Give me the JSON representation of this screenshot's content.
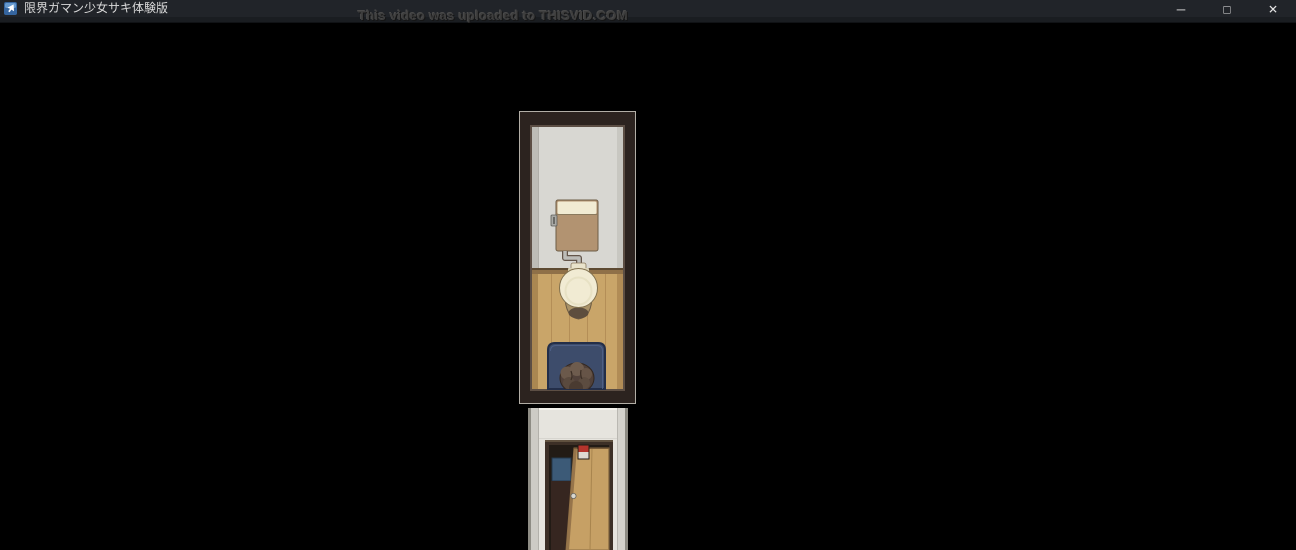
{
  "window": {
    "title": "限界ガマン少女サキ体験版",
    "controls": {
      "minimize_icon": "─",
      "maximize_icon": "□",
      "close_icon": "✕"
    }
  },
  "overlay": {
    "watermark": "This video was uploaded to THISVID.COM"
  },
  "colors": {
    "titlebar_bg": "#212429",
    "titlebar_text": "#d9d9d9",
    "control_icon": "#e4e4e4",
    "watermark_text": "#3e3e3e",
    "background": "#000000",
    "frame_brown": "#2c231f",
    "frame_highlight": "#5c4e44",
    "wall_gray": "#d8d7d2",
    "floor_wood": "#c9a569",
    "tank_tan": "#b29371",
    "porcelain": "#f1ebd3",
    "mat_navy": "#3d4c6b",
    "hair_brown": "#51413a",
    "lower_wall": "#e6e4de",
    "door_wood": "#c6a065",
    "door_frame": "#3c2f26",
    "poster_blue": "#3c5a77",
    "sign_red": "#b5342c"
  }
}
